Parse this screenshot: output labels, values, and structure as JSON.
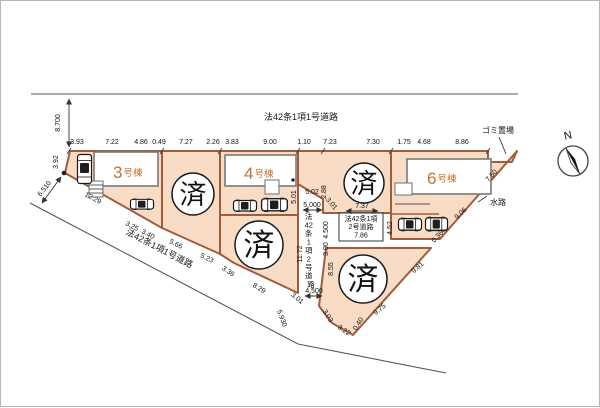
{
  "plan": {
    "sold_label": "済",
    "north_label": "N",
    "garbage_label": "ゴミ置場",
    "waterway_label": "水路",
    "road_top": "法42条1項1号道路",
    "road_diagonal": "法42条1項1号道路",
    "road_vertical_tokens": [
      "法",
      "42",
      "条",
      "1",
      "項",
      "2",
      "号",
      "道",
      "路"
    ],
    "road_branch_box": {
      "line1": "法42条1項",
      "line2": "2号道路",
      "width": "7.86"
    },
    "buildings": {
      "b3": {
        "num": "3",
        "suffix": "号棟"
      },
      "b4": {
        "num": "4",
        "suffix": "号棟"
      },
      "b6": {
        "num": "6",
        "suffix": "号棟"
      }
    },
    "dims": {
      "top": [
        "3.93",
        "7.22",
        "4.86",
        "0.49",
        "7.27",
        "2.26",
        "3.83",
        "9.00",
        "1.10",
        "7.23",
        "7.30",
        "1.75",
        "4.68",
        "8.86"
      ],
      "left": [
        "8.700",
        "3.92",
        "6.510"
      ],
      "south_edge": [
        "12.29",
        "3.25",
        "3.40",
        "5.66",
        "5.23",
        "3.36",
        "8.29"
      ],
      "center": [
        "5.02",
        "2.88",
        "5.01",
        "5.000",
        "3.01",
        "4.500",
        "3.00",
        "8.55",
        "11.72",
        "7.37",
        "4.52"
      ],
      "bottom": [
        "3.01",
        "4.500",
        "5.930",
        "3.03",
        "3.22",
        "0.40",
        "9.75"
      ],
      "east_edge": [
        "9.81",
        "0.36",
        "9.06",
        "7.50"
      ]
    },
    "colors": {
      "lot_fill": "#f9dcc6",
      "lot_stroke": "#a25c3b",
      "building_label": "#c8702e"
    }
  }
}
